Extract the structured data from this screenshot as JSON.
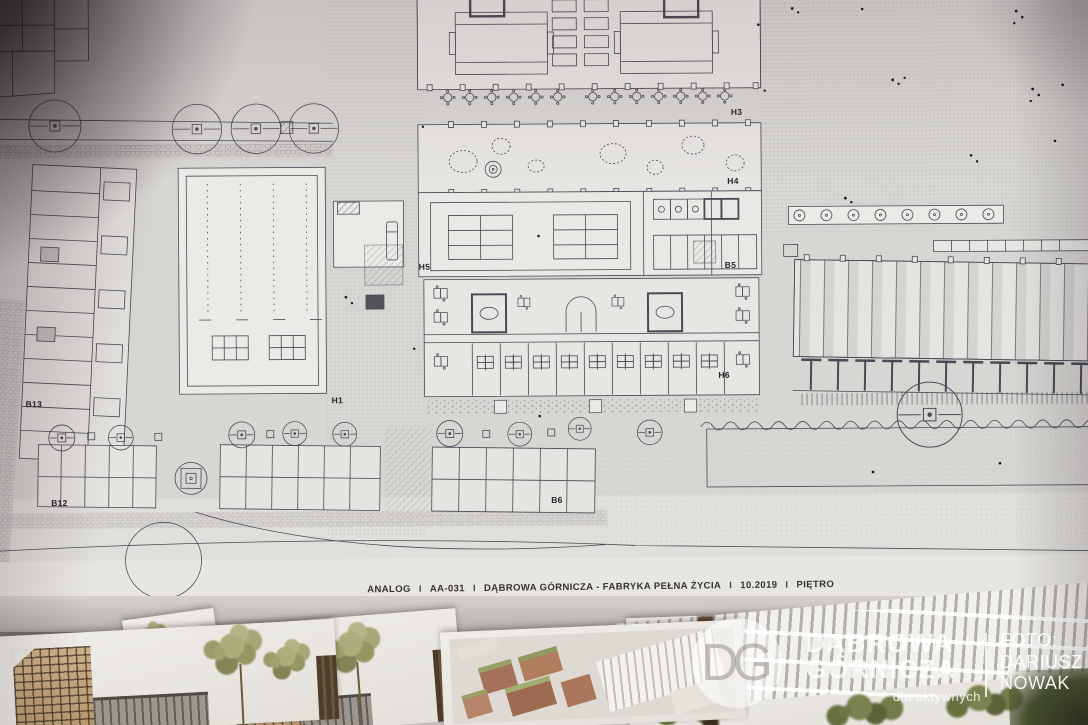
{
  "photo": {
    "caption": {
      "studio": "ANALOG",
      "sep": "I",
      "sheet_no": "AA-031",
      "project": "DĄBROWA GÓRNICZA - FABRYKA PEŁNA ŻYCIA",
      "date": "10.2019",
      "drawing_title": "PIĘTRO"
    },
    "plan_labels": [
      {
        "id": "H3"
      },
      {
        "id": "H4"
      },
      {
        "id": "B5"
      },
      {
        "id": "H5"
      },
      {
        "id": "H6"
      },
      {
        "id": "H1"
      },
      {
        "id": "B13"
      },
      {
        "id": "B12"
      },
      {
        "id": "B6"
      }
    ],
    "watermark": {
      "logo": "DG",
      "org_line1": "DĄBROWA",
      "org_line2": "GÓRNICZA",
      "tagline": "dla aktywnych",
      "credit_label": "FOTO:",
      "credit_first_name": "DARIUSZ",
      "credit_last_name": "NOWAK"
    },
    "colors": {
      "sheet": "#d8d6d3",
      "ink": "#4b4854",
      "watermark_white": "rgba(255,255,255,0.78)",
      "render_tan": "#c2a379",
      "render_olive": "#96995f",
      "render_brick": "#a9765b"
    }
  }
}
